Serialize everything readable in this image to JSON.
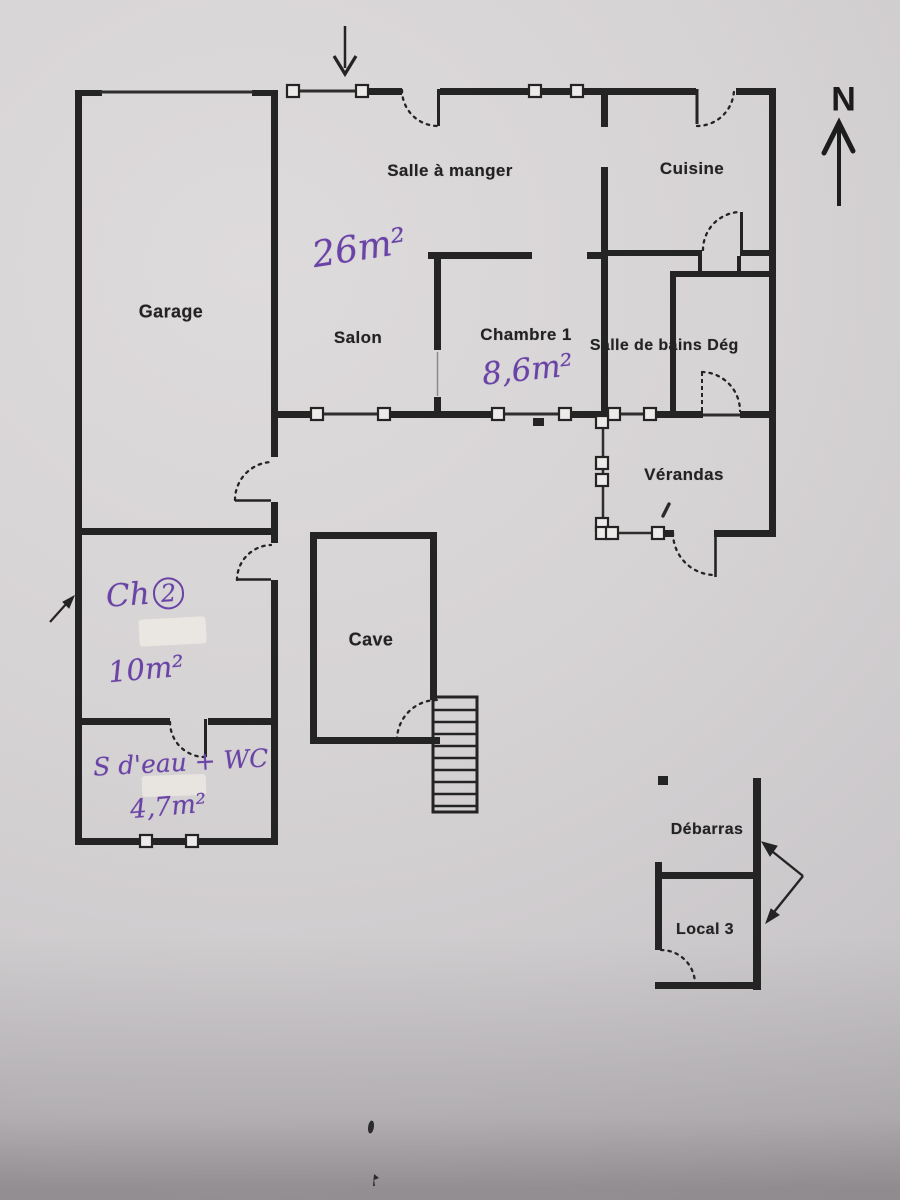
{
  "document": {
    "kind": "floor-plan-scan",
    "compass_label": "N"
  },
  "rooms": {
    "salle_a_manger": "Salle à manger",
    "cuisine": "Cuisine",
    "garage": "Garage",
    "salon": "Salon",
    "chambre1": "Chambre 1",
    "salle_de_bains": "Salle de bains",
    "deg": "Dég",
    "verandas": "Vérandas",
    "cave": "Cave",
    "debarras": "Débarras",
    "local3": "Local 3"
  },
  "annotations": {
    "salle_a_manger_area": "26m²",
    "chambre1_area": "8,6m²",
    "ch2_prefix": "Ch",
    "ch2_number": "2",
    "ch2_area": "10m²",
    "sdeau_label": "S d'eau + WC",
    "sdeau_area": "4,7m²"
  },
  "colors": {
    "ink": "#6a43a6",
    "wall": "#242424",
    "paper": "#d6d3d4"
  }
}
